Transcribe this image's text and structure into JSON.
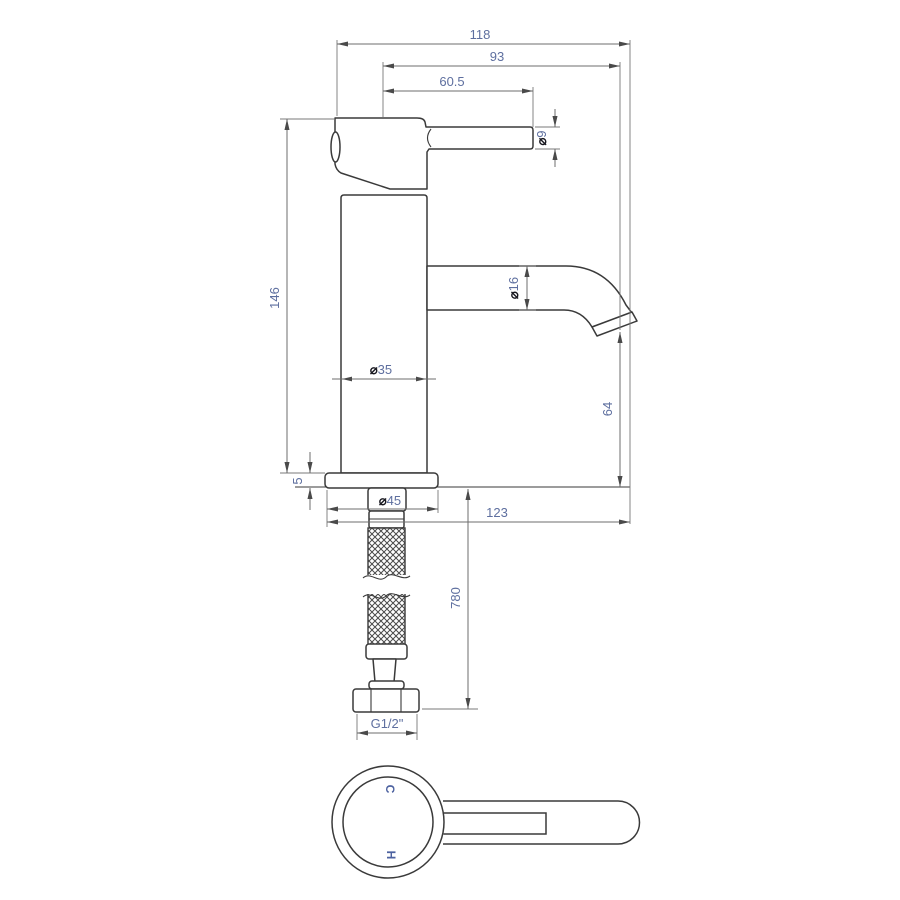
{
  "drawing": {
    "title": "Basin mixer tap technical drawing",
    "views": {
      "front": "front elevation with supply hose",
      "top": "handle plan view"
    }
  },
  "dims": {
    "total_width": "118",
    "spout_projection": "93",
    "handle_reach": "60.5",
    "lever_dia_sym": "⌀",
    "lever_dia": "9",
    "body_height": "146",
    "spout_dia_sym": "⌀",
    "spout_dia": "16",
    "column_dia_sym": "⌀",
    "column_dia": "35",
    "outlet_height": "64",
    "base_thickness": "5",
    "base_dia_sym": "⌀",
    "base_dia": "45",
    "base_depth": "123",
    "hose_length": "780",
    "inlet_thread": "G1/2\"",
    "cold_marker": "C",
    "hot_marker": "H"
  },
  "colors": {
    "line": "#3a3a3a",
    "dimension_line": "#6d6d6d",
    "dimension_text": "#5e6f9f",
    "diameter_symbol": "#17171f",
    "background": "#ffffff"
  }
}
